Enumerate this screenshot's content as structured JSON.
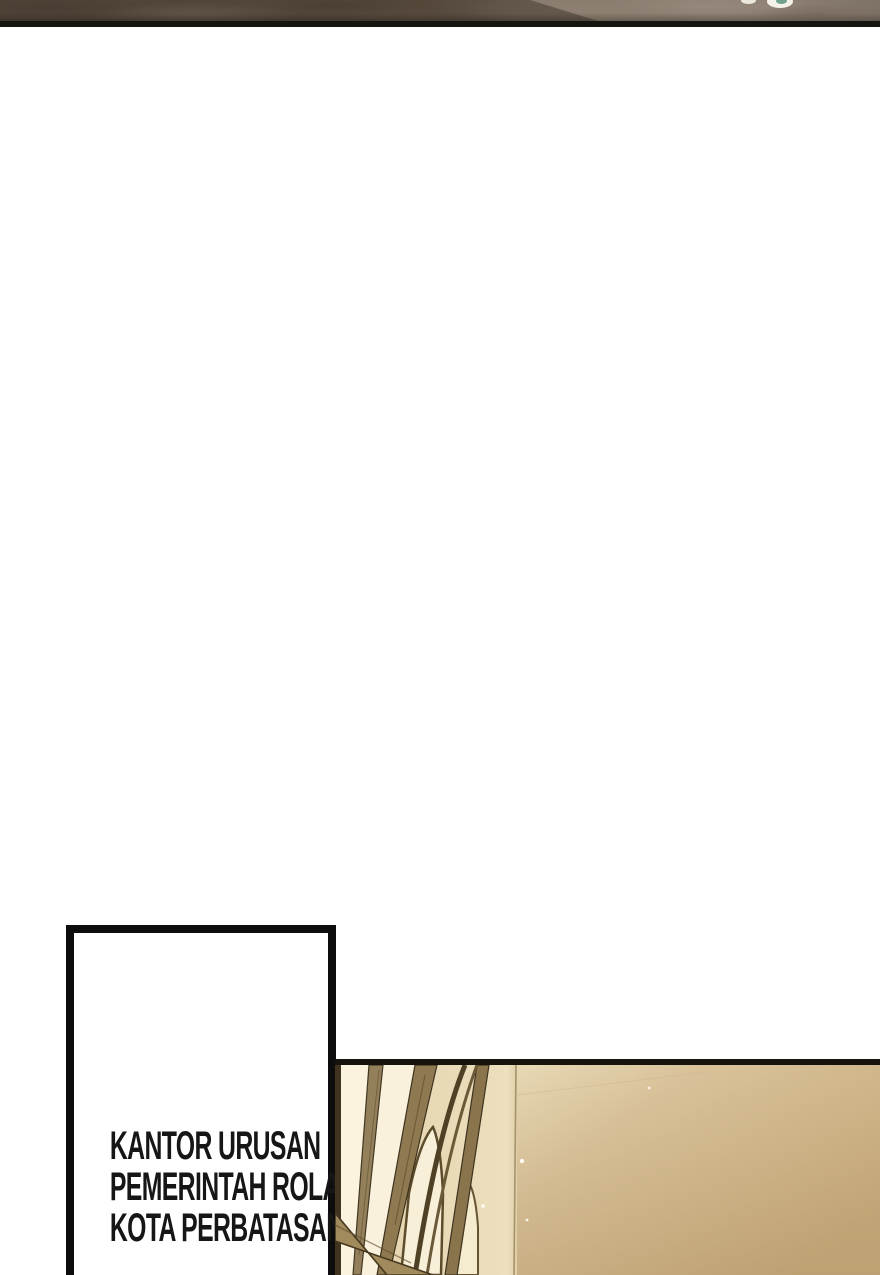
{
  "page_type": "webtoon-comic-page",
  "top_strip": {
    "description": "bottom edge of previous panel, rocky brown texture",
    "texture_colors": [
      "#50443a",
      "#6b5c50",
      "#837366",
      "#8d7e71",
      "#96897c"
    ],
    "divider_color": "#15140f",
    "beads": {
      "white": "#f4f1e8",
      "teal_highlight": "#6fa18c"
    }
  },
  "caption_box": {
    "lines": [
      "KANTOR URUSAN",
      "PEMERINTAH ROLAND,",
      "KOTA PERBATASAN"
    ],
    "border_color": "#0d0d0d",
    "background": "#ffffff",
    "text_color": "#161616"
  },
  "panel": {
    "description": "interior with tall gothic arched windows, warm light",
    "border_color": "#16130c",
    "window_light_color": "#fbf3de",
    "frame_color": "#8f7950",
    "frame_dark_color": "#45381f",
    "wall_light_color": "#e8dab6",
    "wall_dark_color": "#c8ac7d",
    "sparkle_color": "#fffdf4"
  }
}
